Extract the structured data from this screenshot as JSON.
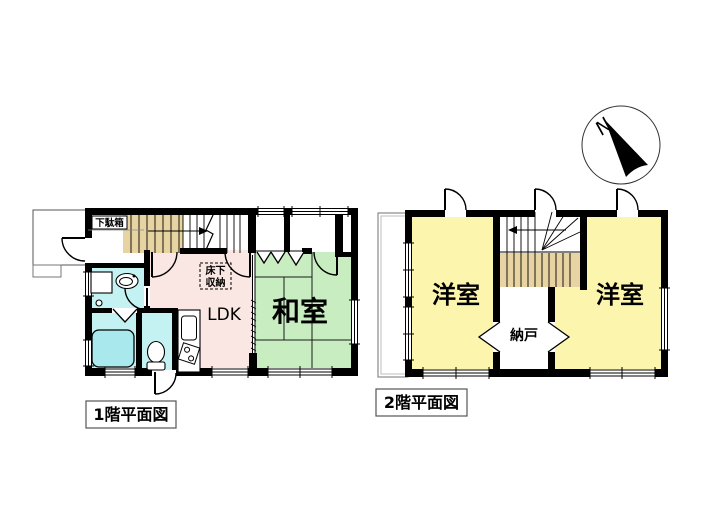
{
  "compass": {
    "north_label": "N"
  },
  "floor1": {
    "caption": "1階平面図",
    "rooms": {
      "getabako_label": "下駄箱",
      "yukashita_line1": "床下",
      "yukashita_line2": "収納",
      "ldk_label": "LDK",
      "washitsu_label": "和室"
    },
    "colors": {
      "ldk": "#fae7e3",
      "washitsu": "#c8edc0",
      "water": "#c4f2f2",
      "bathtub": "#a9e9ed",
      "stairs": "#e8d4a2"
    }
  },
  "floor2": {
    "caption": "2階平面図",
    "rooms": {
      "yoshitsu_left_label": "洋室",
      "yoshitsu_right_label": "洋室",
      "nando_label": "納戸"
    },
    "colors": {
      "yoshitsu": "#fcf5ad",
      "stairs": "#e8d4a2"
    }
  }
}
